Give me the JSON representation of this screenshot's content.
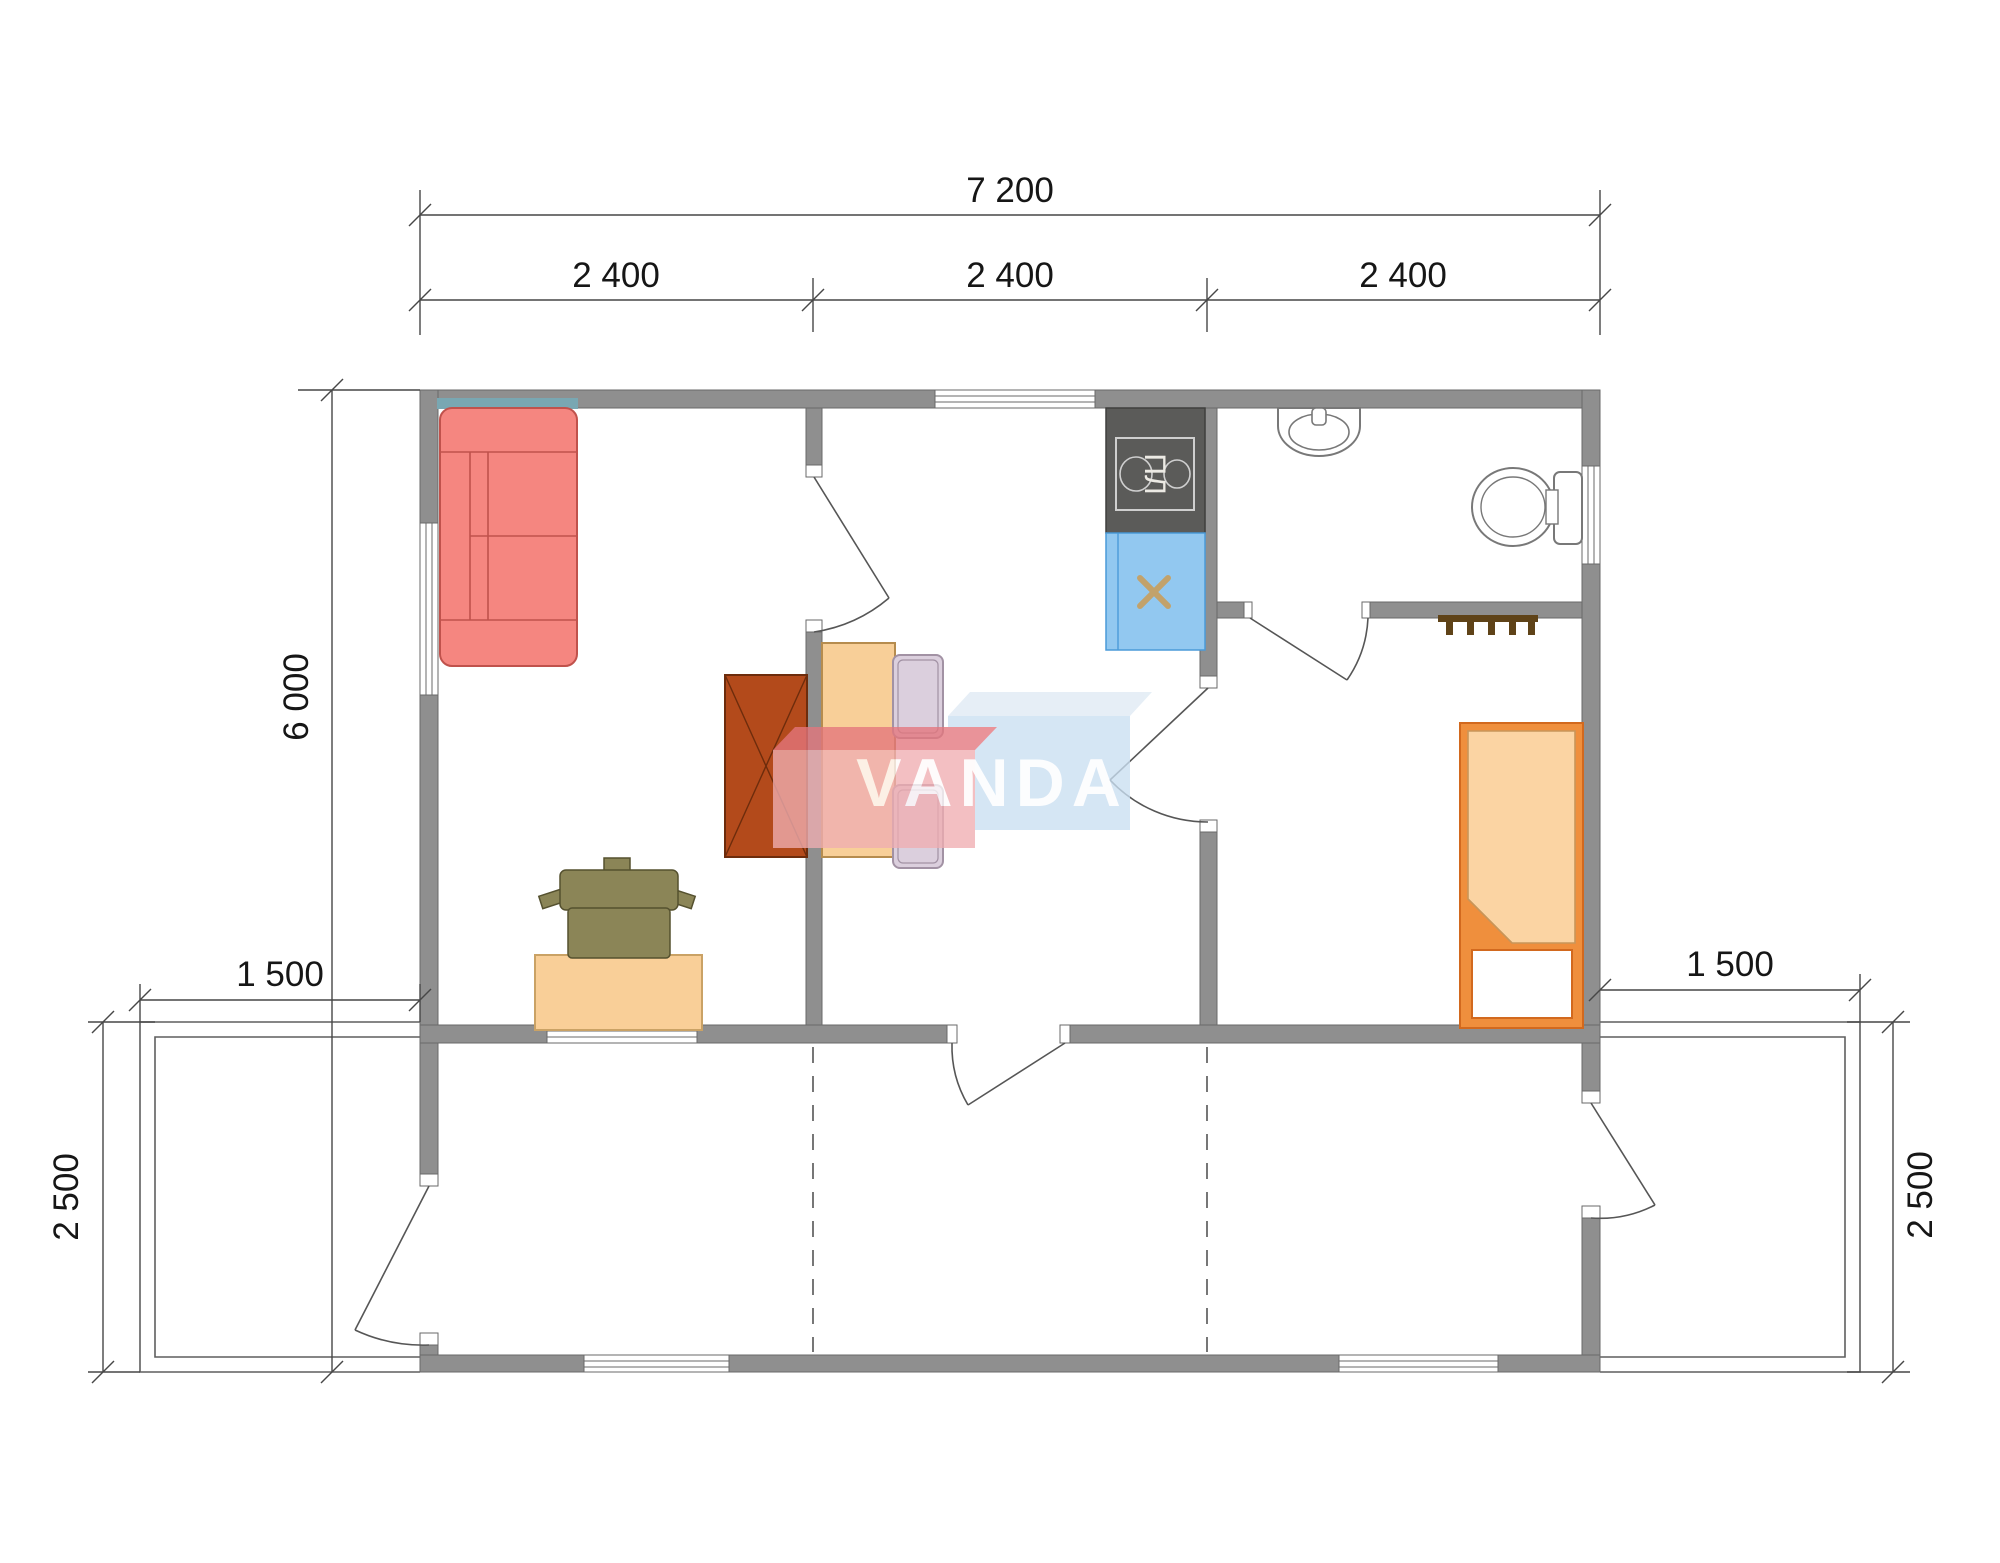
{
  "drawing": {
    "watermark_text": "VANDA",
    "stove_label": "ПЛ"
  },
  "dimensions": {
    "overall_width": "7 200",
    "modules": [
      "2 400",
      "2 400",
      "2 400"
    ],
    "overall_depth": "6 000",
    "left_deck_width": "1 500",
    "right_deck_width": "1 500",
    "left_terrace_depth": "2 500",
    "right_terrace_depth": "2 500"
  },
  "fixtures": [
    "sofa",
    "wardrobe",
    "dining-table",
    "dining-chair",
    "dining-chair",
    "desk",
    "office-chair",
    "bed",
    "coat-rack",
    "stove",
    "kitchen-sink",
    "bathroom-sink",
    "toilet"
  ],
  "colors": {
    "wall": "#8f8f8f",
    "sofa": "#f58680",
    "wardrobe": "#b34a1b",
    "dining_table": "#f8cf98",
    "dining_chair": "#dbcfdd",
    "desk": "#f9cf98",
    "office_chair": "#8b8557",
    "bed_frame": "#ef8f3d",
    "bed_blanket": "#fbd4a3",
    "stove": "#5b5b59",
    "kitchen_sink_unit": "#92c8f0",
    "accent_teal": "#79a7b2",
    "watermark_red": "#f0aeb2",
    "watermark_blue": "#cadff2"
  }
}
